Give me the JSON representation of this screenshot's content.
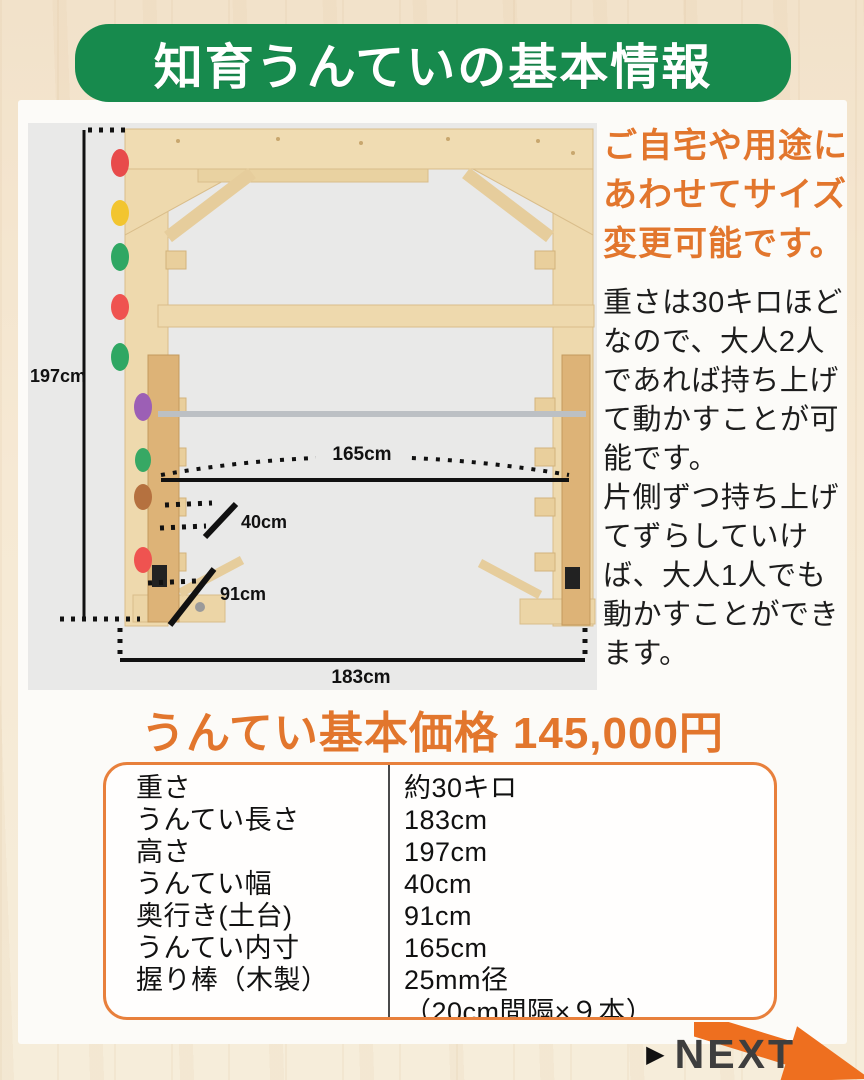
{
  "title": "知育うんていの基本情報",
  "diagram": {
    "dims": {
      "height": "197cm",
      "inner": "165cm",
      "width": "40cm",
      "depth": "91cm",
      "length": "183cm"
    },
    "hold_colors": [
      "#e84b4b",
      "#f2c52f",
      "#2fa763",
      "#ef5350",
      "#2fa763",
      "#9c5fb5",
      "#37a864",
      "#b5713f",
      "#ef5350"
    ]
  },
  "sidebar": {
    "headline": "ご自宅や用途に\nあわせてサイズ\n変更可能です。",
    "body": "重さは30キロほど\nなので、大人2人\nであれば持ち上げ\nて動かすことが可\n能です。\n片側ずつ持ち上げ\nてずらしていけ\nば、大人1人でも\n動かすことができ\nます。"
  },
  "price": {
    "label": "うんてい基本価格",
    "amount": "145,000円"
  },
  "specs": {
    "rows": [
      {
        "label": "重さ",
        "value": "約30キロ"
      },
      {
        "label": "うんてい長さ",
        "value": "183cm"
      },
      {
        "label": "高さ",
        "value": "197cm"
      },
      {
        "label": "うんてい幅",
        "value": "40cm"
      },
      {
        "label": "奥行き(土台)",
        "value": "91cm"
      },
      {
        "label": "うんてい内寸",
        "value": "165cm"
      },
      {
        "label": "握り棒（木製）",
        "value": "25mm径\n（20cm間隔×９本）"
      }
    ]
  },
  "footer": {
    "next_icon": "▶",
    "next_label": "NEXT"
  },
  "colors": {
    "green": "#178a4d",
    "orange": "#e2762d",
    "arrow_orange": "#ee6f1f"
  }
}
